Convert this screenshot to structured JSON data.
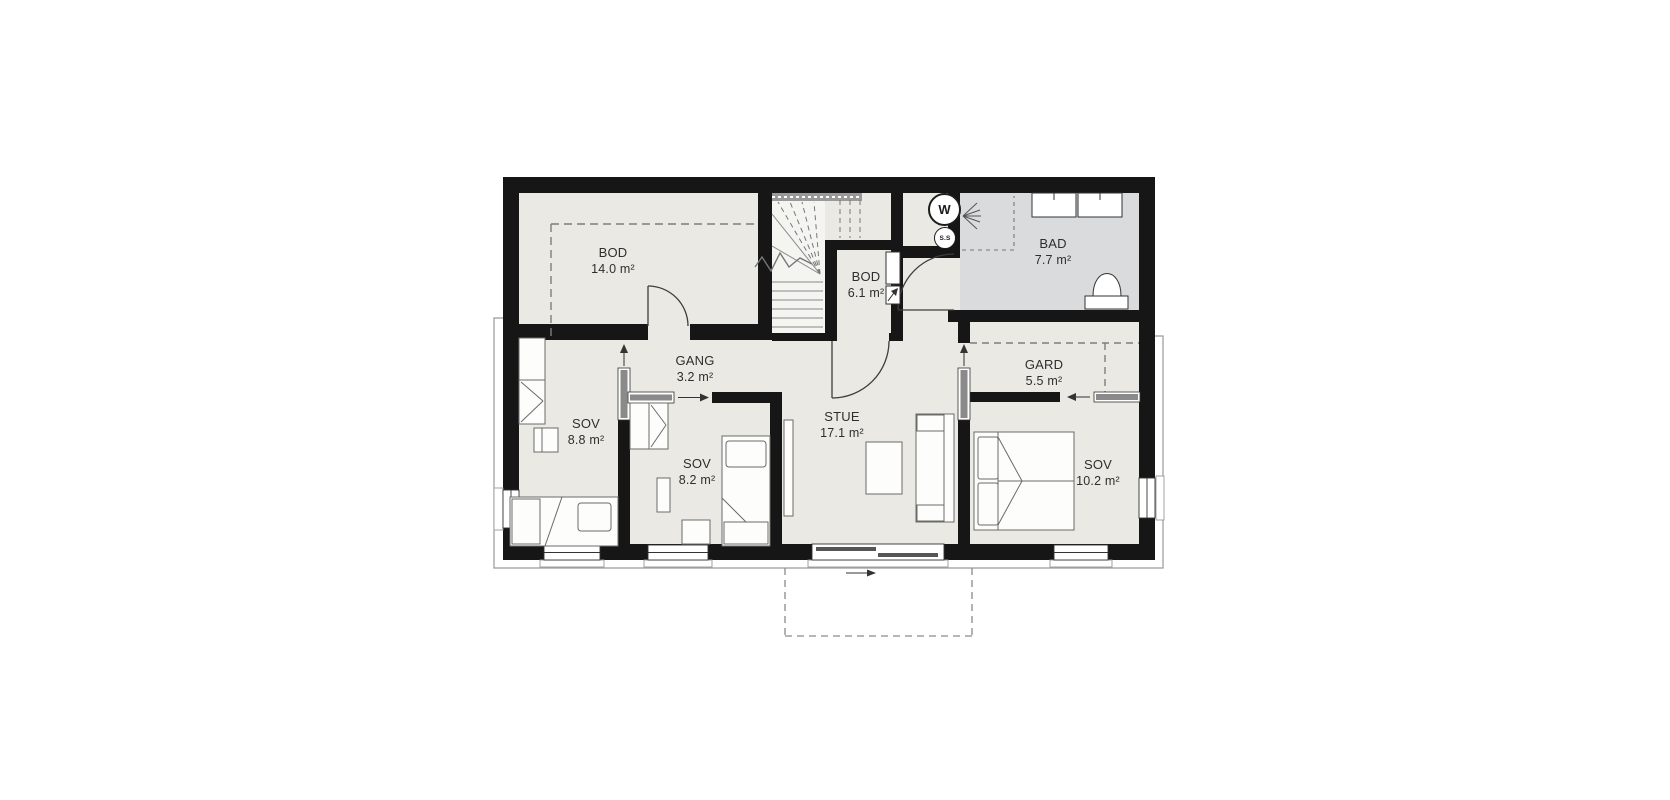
{
  "plan": {
    "rooms": [
      {
        "name": "BOD",
        "area": "14.0 m²"
      },
      {
        "name": "BOD",
        "area": "6.1 m²"
      },
      {
        "name": "BAD",
        "area": "7.7 m²"
      },
      {
        "name": "GANG",
        "area": "3.2 m²"
      },
      {
        "name": "GARD",
        "area": "5.5 m²"
      },
      {
        "name": "SOV",
        "area": "8.8 m²"
      },
      {
        "name": "SOV",
        "area": "8.2 m²"
      },
      {
        "name": "STUE",
        "area": "17.1 m²"
      },
      {
        "name": "SOV",
        "area": "10.2 m²"
      }
    ],
    "appliances": {
      "washer": "W",
      "ss": "S.S"
    },
    "colors": {
      "wall": "#161616",
      "floor": "#eae9e4",
      "bath_floor": "#d9dbdd"
    }
  }
}
